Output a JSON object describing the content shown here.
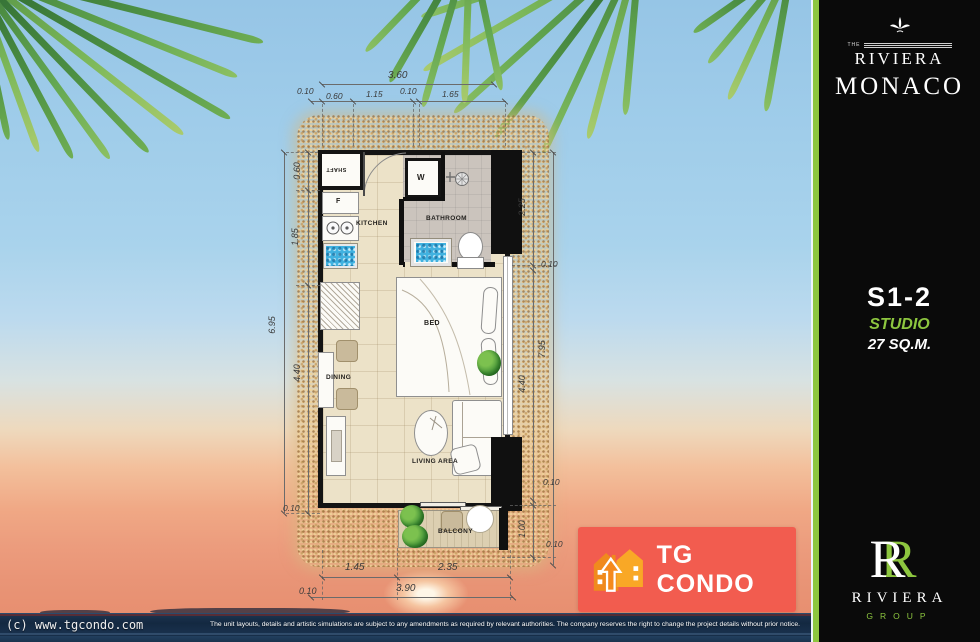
{
  "sidebar": {
    "the": "THE",
    "brand": "RIVIERA",
    "project": "MONACO",
    "unit_code": "S1-2",
    "unit_type": "STUDIO",
    "unit_area": "27 SQ.M.",
    "group_monogram": "R",
    "group_name": "RIVIERA",
    "group_word": "GROUP"
  },
  "watermark": {
    "text": "TG CONDO"
  },
  "footer": {
    "copyright": "(c) www.tgcondo.com",
    "disclaimer": "The unit layouts, details and artistic simulations are subject to any amendments as required by relevant authorities. The company reserves the right to change the project details without prior notice."
  },
  "floorplan": {
    "rooms": {
      "shaft": "SHAFT",
      "fridge": "F",
      "washer": "W",
      "kitchen": "KITCHEN",
      "bathroom": "BATHROOM",
      "bed": "BED",
      "dining": "DINING",
      "living": "LIVING AREA",
      "balcony": "BALCONY"
    },
    "dims": {
      "top_total": "3.60",
      "top_segs": [
        "0.10",
        "0.60",
        "1.15",
        "0.10",
        "1.65"
      ],
      "left": [
        "0.60",
        "1.85",
        "6.95",
        "4.40",
        "0.10"
      ],
      "right": [
        "2.25",
        "0.10",
        "7.95",
        "4.40",
        "0.10",
        "1.00",
        "0.10"
      ],
      "bottom": [
        "1.45",
        "2.35",
        "0.10",
        "3.90"
      ]
    }
  },
  "colors": {
    "accent_green": "#8dc63f",
    "watermark_red": "#f2594b",
    "house_orange": "#f6921e"
  }
}
